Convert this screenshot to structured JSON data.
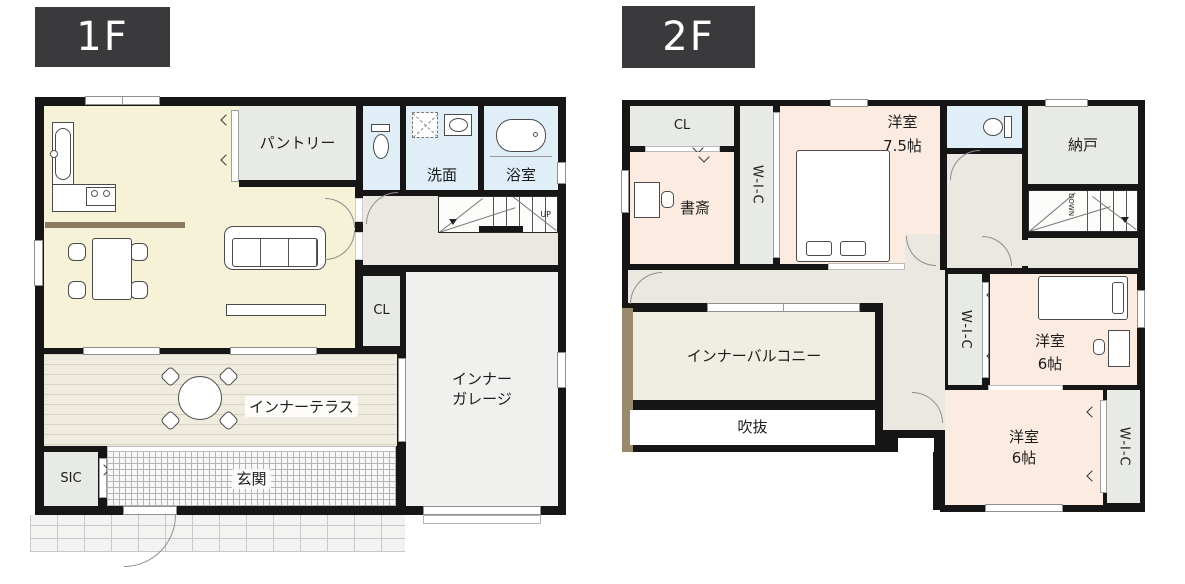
{
  "floors": {
    "f1": {
      "tag": "1F",
      "pantry": "パントリー",
      "washroom": "洗面",
      "bath": "浴室",
      "closet": "CL",
      "terrace": "インナーテラス",
      "garage1": "インナー",
      "garage2": "ガレージ",
      "sic": "SIC",
      "entrance": "玄関",
      "stairs_up": "UP"
    },
    "f2": {
      "tag": "2F",
      "closet": "CL",
      "study": "書斎",
      "wic1": "W-I-C",
      "wic2": "W-I-C",
      "wic3": "W-I-C",
      "bedroom75_1": "洋室",
      "bedroom75_2": "7.5帖",
      "storage": "納戸",
      "stairs_down": "DOWN",
      "balcony": "インナーバルコニー",
      "void": "吹抜",
      "bedroom6a_1": "洋室",
      "bedroom6a_2": "6帖",
      "bedroom6b_1": "洋室",
      "bedroom6b_2": "6帖"
    },
    "colors": {
      "wall": "#161616",
      "floor_tag_bg": "#3a3a3c",
      "ldk_cream": "#f5f2d8",
      "storage_gray": "#e8eae6",
      "wet_blue": "#dfeef7",
      "hall_greige": "#ebe8e1",
      "garage_gray": "#f0f0ee",
      "terrace_base": "#efecdf",
      "room_peach": "#fcebe0",
      "balcony_beige": "#f0ede3",
      "counter_brown": "#8d7c60",
      "balcony_edge_brown": "#998a6e"
    }
  }
}
